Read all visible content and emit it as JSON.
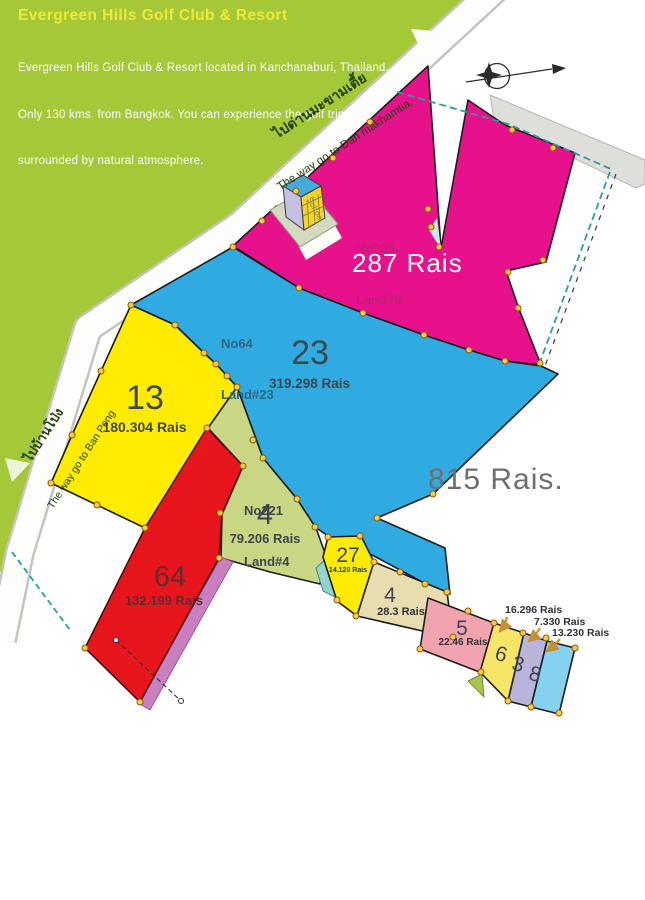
{
  "header": {
    "title": "Evergreen Hills Golf Club & Resort",
    "description_lines": [
      "Evergreen Hills Golf Club & Resort located in Kanchanaburi, Thailand.",
      "Only 130 kms. from Bangkok. You can experience the golf trip",
      "surrounded by natural atmosphere."
    ]
  },
  "roads": {
    "dan": {
      "thai": "ไปด่านมะขามเตี้ย",
      "english": "The way go to Dan makhamtia."
    },
    "ban_pong": {
      "thai": "ไปบ้านโป่ง",
      "english": "The way go to Ban Pong"
    }
  },
  "total_area": "815 Rais.",
  "school_label": "School",
  "parcels": {
    "p225": {
      "no": "No225",
      "land": "Land#8",
      "area": "287 Rais"
    },
    "p23": {
      "no": "No64",
      "land": "Land#23",
      "number": "23",
      "area": "319.298 Rais"
    },
    "p13": {
      "number": "13",
      "area": "180.304 Rais"
    },
    "p4a": {
      "no": "No221",
      "land": "Land#4",
      "number": "4",
      "area": "79.206 Rais"
    },
    "p64": {
      "number": "64",
      "area": "132.199 Rais"
    },
    "p27": {
      "number": "27",
      "area": "14.120 Rais"
    },
    "p4b": {
      "number": "4",
      "area": "28.3 Rais"
    },
    "p5": {
      "number": "5",
      "area": "22.46 Rais"
    },
    "p6": {
      "number": "6",
      "area": "16.296 Rais"
    },
    "p3": {
      "number": "3",
      "area": "7.330 Rais"
    },
    "p8": {
      "number": "8",
      "area": "13.230 Rais"
    }
  },
  "colors": {
    "green_band": "#a5c838",
    "magenta": "#e8118c",
    "blue": "#2fabe1",
    "yellow": "#ffec00",
    "light_green": "#c9d684",
    "red": "#e9151d",
    "tan": "#e7ddae",
    "pink": "#f2a3b0",
    "lavender": "#b9b4da",
    "light_blue": "#85d1f0",
    "purple": "#c77fc0",
    "boundary_teal": "#2a9d9c"
  }
}
